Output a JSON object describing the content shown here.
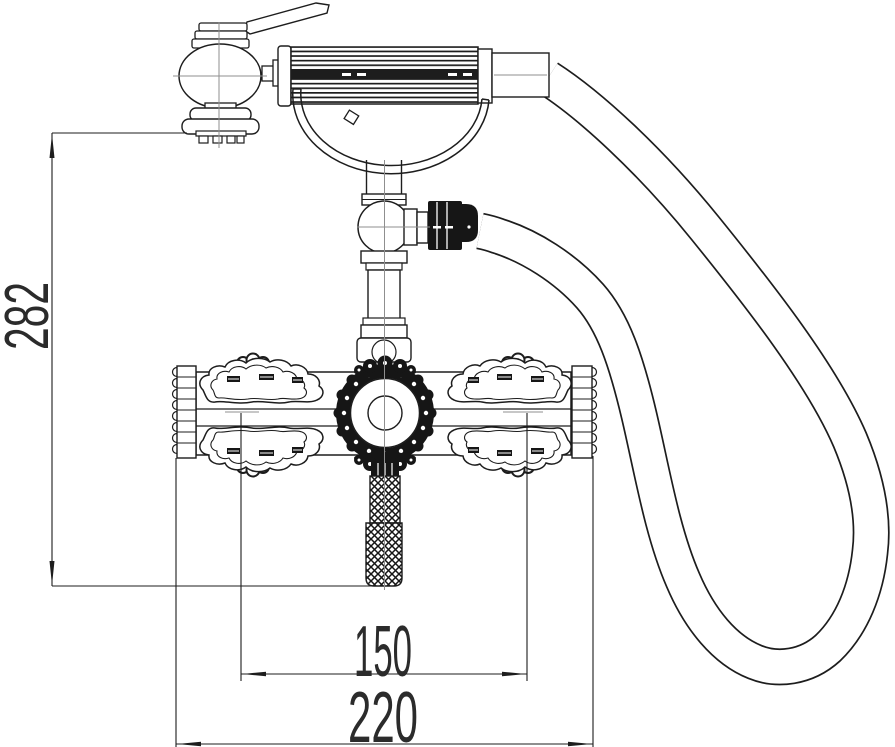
{
  "drawing": {
    "kind": "faucet-technical-line-drawing",
    "dimensions": {
      "overall_height_label": "282",
      "port_spacing_label": "150",
      "overall_width_label": "220"
    },
    "colors": {
      "line": "#1d1d1d",
      "dark_fill": "#161616",
      "centerline": "#8f8f8f",
      "background": "#ffffff"
    }
  }
}
